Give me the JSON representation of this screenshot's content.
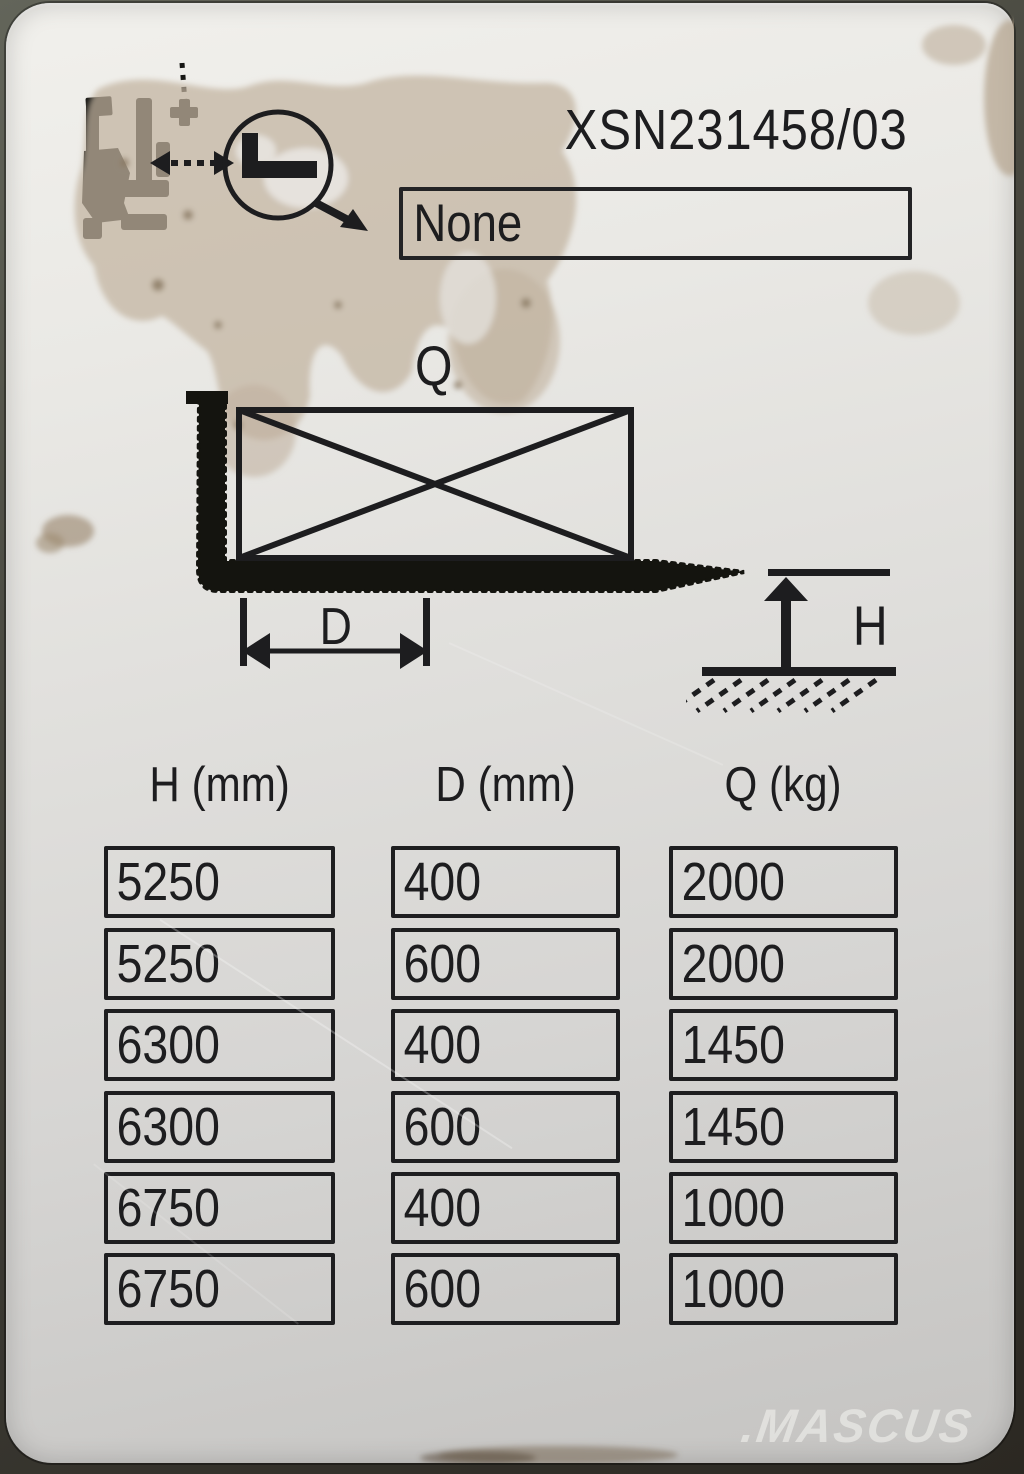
{
  "plate": {
    "serial_number": "XSN231458/03",
    "attachment_box": {
      "value": "None"
    },
    "diagram": {
      "load_label": "Q",
      "load_center_label": "D",
      "lift_height_label": "H"
    },
    "capacity_table": {
      "columns": [
        "H (mm)",
        "D (mm)",
        "Q (kg)"
      ],
      "rows": [
        [
          "5250",
          "400",
          "2000"
        ],
        [
          "5250",
          "600",
          "2000"
        ],
        [
          "6300",
          "400",
          "1450"
        ],
        [
          "6300",
          "600",
          "1450"
        ],
        [
          "6750",
          "400",
          "1000"
        ],
        [
          "6750",
          "600",
          "1000"
        ]
      ]
    },
    "icons": [
      "forklift-pictogram-icon",
      "fork-magnifier-icon",
      "fork-load-diagram",
      "lift-height-diagram"
    ],
    "colors": {
      "print": "#1d1d1f",
      "plate_light": "#f1f0ec",
      "plate_dark": "#c5c4c2",
      "stain": "#c2b3a0",
      "background": "#3a3831"
    }
  },
  "watermark": {
    "text": ".MASCUS"
  }
}
